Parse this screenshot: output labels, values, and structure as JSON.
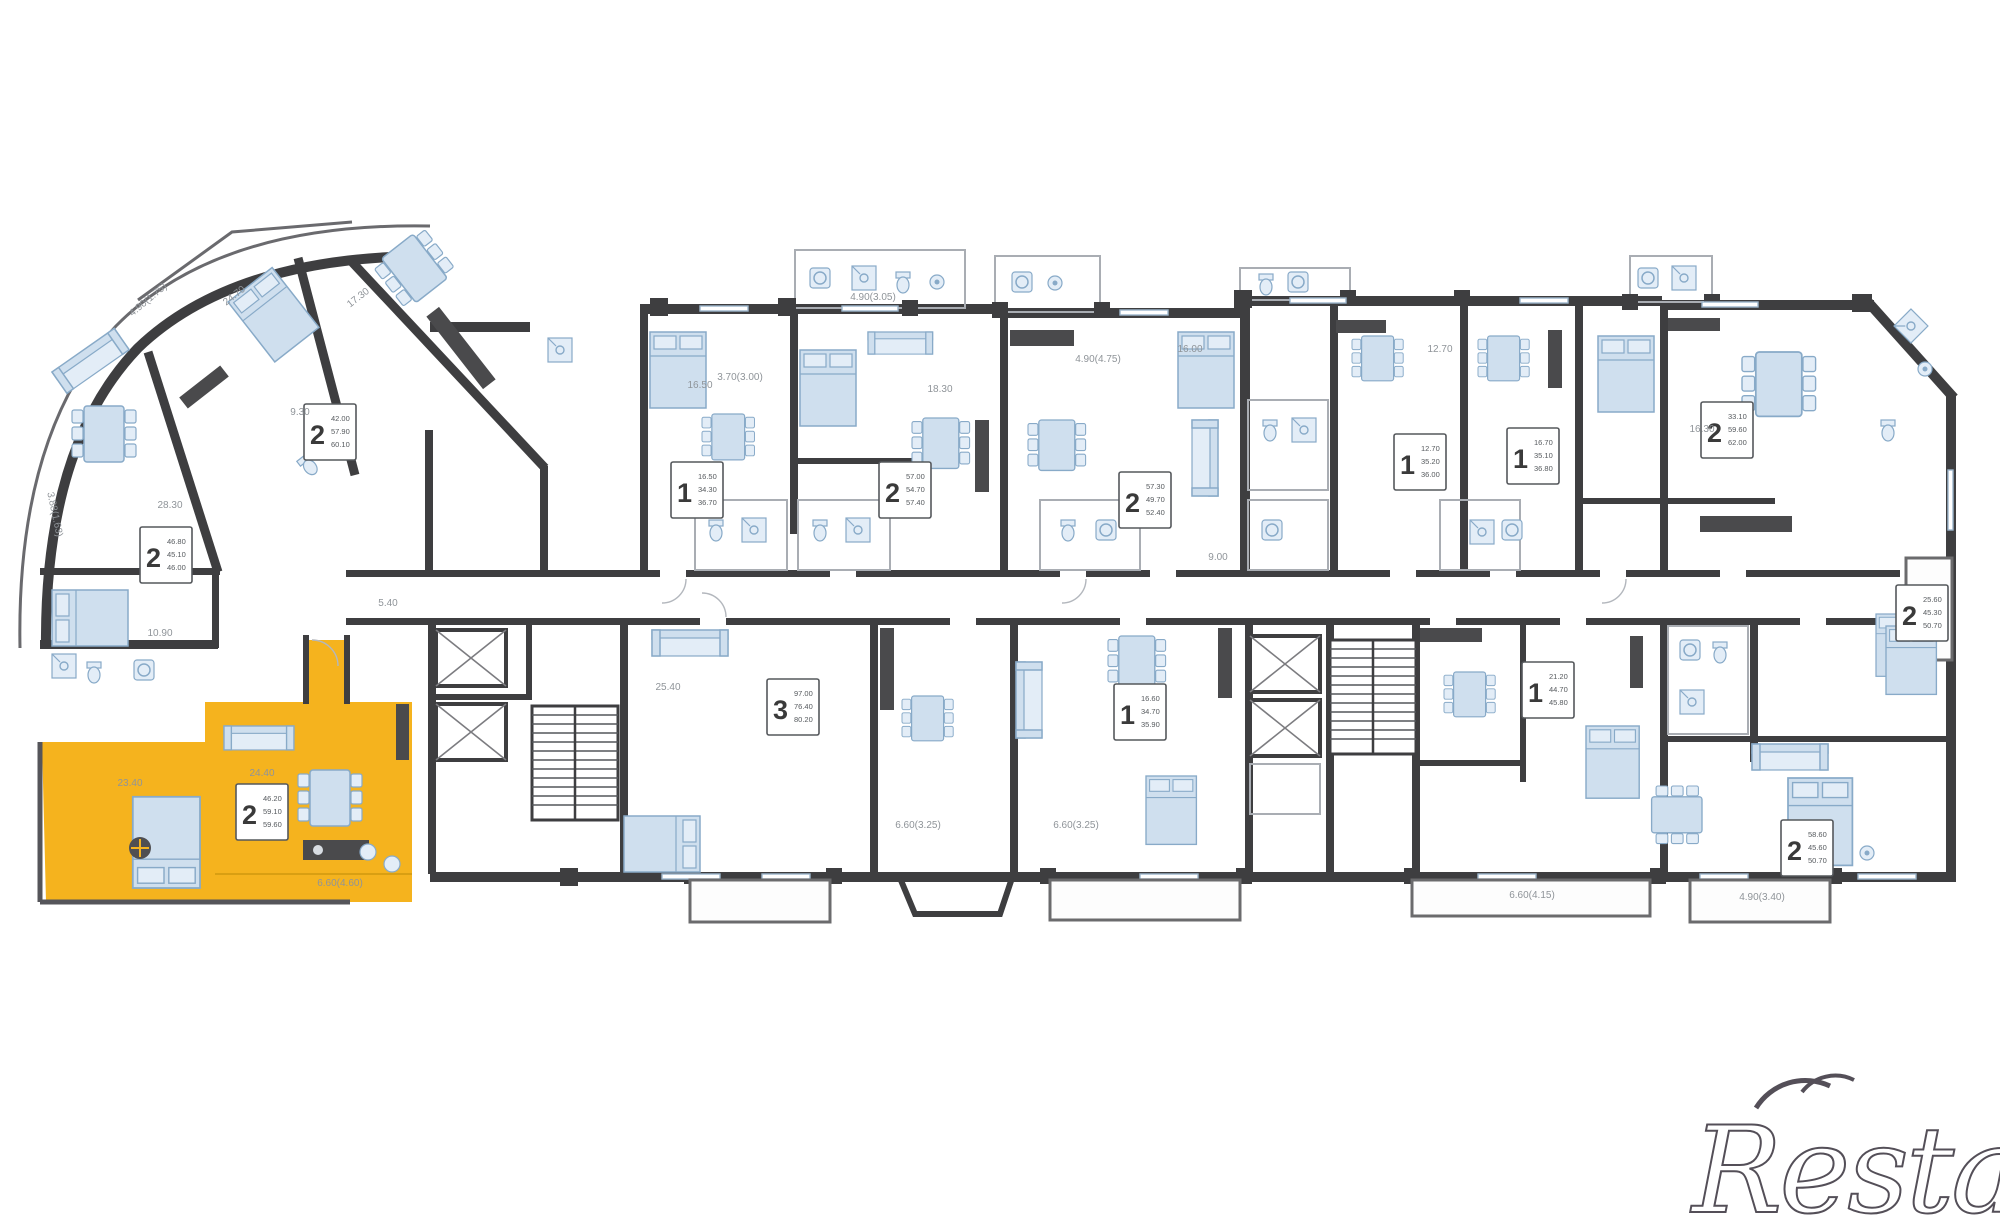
{
  "page": {
    "watermark": "Restate"
  },
  "colors": {
    "highlight": "#f5b31e",
    "wall": "#3e3e40",
    "furniture_fill": "#cfdfee",
    "furniture_stroke": "#88aac8",
    "dim_text": "#8f9499",
    "watermark": "#544f58"
  },
  "apartments": [
    {
      "num": "2",
      "lines": [
        "46.80",
        "45.10",
        "46.00"
      ]
    },
    {
      "num": "2",
      "lines": [
        "42.00",
        "57.90",
        "60.10"
      ]
    },
    {
      "num": "2",
      "lines": [
        "46.20",
        "59.10",
        "59.60"
      ],
      "highlighted": true
    },
    {
      "num": "1",
      "lines": [
        "16.50",
        "34.30",
        "36.70"
      ]
    },
    {
      "num": "2",
      "lines": [
        "57.00",
        "54.70",
        "57.40"
      ]
    },
    {
      "num": "2",
      "lines": [
        "57.30",
        "49.70",
        "52.40"
      ]
    },
    {
      "num": "1",
      "lines": [
        "12.70",
        "35.20",
        "36.00"
      ]
    },
    {
      "num": "1",
      "lines": [
        "16.70",
        "35.10",
        "36.80"
      ]
    },
    {
      "num": "2",
      "lines": [
        "33.10",
        "59.60",
        "62.00"
      ]
    },
    {
      "num": "2",
      "lines": [
        "25.60",
        "45.30",
        "50.70"
      ]
    },
    {
      "num": "3",
      "lines": [
        "97.00",
        "76.40",
        "80.20"
      ]
    },
    {
      "num": "1",
      "lines": [
        "16.60",
        "34.70",
        "35.90"
      ]
    },
    {
      "num": "1",
      "lines": [
        "21.20",
        "44.70",
        "45.80"
      ]
    },
    {
      "num": "2",
      "lines": [
        "58.60",
        "45.60",
        "50.70"
      ]
    }
  ],
  "dims": [
    {
      "t": "28.30"
    },
    {
      "t": "24.70"
    },
    {
      "t": "17.30"
    },
    {
      "t": "9.30"
    },
    {
      "t": "4.90(1.75)"
    },
    {
      "t": "3.88(1.63)"
    },
    {
      "t": "10.90"
    },
    {
      "t": "5.40"
    },
    {
      "t": "23.40"
    },
    {
      "t": "24.40"
    },
    {
      "t": "6.60(4.60)"
    },
    {
      "t": "16.50"
    },
    {
      "t": "3.70(3.00)"
    },
    {
      "t": "18.30"
    },
    {
      "t": "4.90(4.75)"
    },
    {
      "t": "16.00"
    },
    {
      "t": "25.40"
    },
    {
      "t": "6.60(3.25)"
    },
    {
      "t": "6.60(3.25)"
    },
    {
      "t": "6.60(4.15)"
    },
    {
      "t": "4.90(3.40)"
    },
    {
      "t": "16.30"
    },
    {
      "t": "9.00"
    },
    {
      "t": "12.70"
    },
    {
      "t": "4.90(3.05)"
    }
  ]
}
